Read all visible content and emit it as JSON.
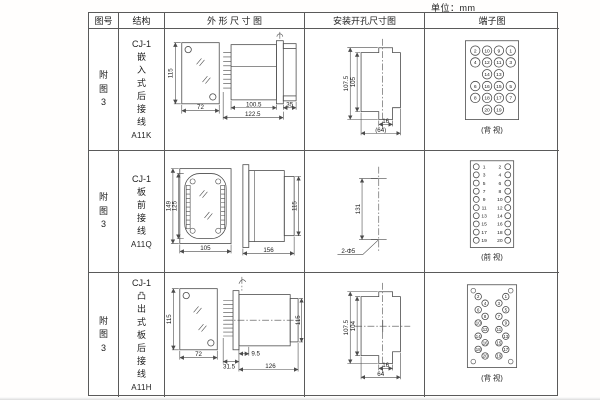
{
  "page": {
    "unit": "单位：mm"
  },
  "headers": {
    "fig": "图号",
    "structure": "结构",
    "outline": "外 形 尺 寸 图",
    "install": "安装开孔尺寸图",
    "terminal": "端子图"
  },
  "rows": [
    {
      "fig": "附图3",
      "model": "CJ-1",
      "mount": "嵌入式后接线",
      "code": "A11K",
      "outline": {
        "h": "115",
        "w": "72",
        "body": "100.5",
        "total": "122.5",
        "right": "35"
      },
      "install": {
        "outer": "107.5",
        "inner": "105",
        "tab": "16",
        "width": "(64)"
      },
      "terminal": {
        "view": "(背 视)",
        "cells": [
          "2",
          "10",
          "9",
          "1",
          "4",
          "12",
          "11",
          "3",
          "14",
          "13",
          "6",
          "16",
          "15",
          "5",
          "8",
          "18",
          "17",
          "7",
          "20",
          "19"
        ]
      }
    },
    {
      "fig": "附图3",
      "model": "CJ-1",
      "mount": "板前接线",
      "code": "A11Q",
      "outline": {
        "outer_h": "149",
        "inner_h": "125",
        "w": "105",
        "len": "156",
        "side_h": "115"
      },
      "install": {
        "spacing": "131",
        "holes": "2-Φ5"
      },
      "terminal": {
        "view": "(前 视)",
        "left": [
          "1",
          "3",
          "5",
          "7",
          "9",
          "11",
          "13",
          "15",
          "17",
          "19"
        ],
        "right": [
          "2",
          "4",
          "6",
          "8",
          "10",
          "12",
          "14",
          "16",
          "18",
          "20"
        ]
      }
    },
    {
      "fig": "附图3",
      "model": "CJ-1",
      "mount": "凸出式板后接线",
      "code": "A11H",
      "outline": {
        "h": "115",
        "w": "72",
        "pins": "31.5",
        "gap": "9.5",
        "body": "126",
        "side_h": "115"
      },
      "install": {
        "outer": "107.5",
        "inner": "104",
        "tab": "16",
        "width": "64"
      },
      "terminal": {
        "view": "(背 视)",
        "left": [
          "2",
          "4",
          "6",
          "8",
          "10",
          "12",
          "14",
          "16",
          "18",
          "20"
        ],
        "right": [
          "1",
          "3",
          "5",
          "7",
          "9",
          "11",
          "13",
          "15",
          "17",
          "19"
        ]
      }
    }
  ]
}
